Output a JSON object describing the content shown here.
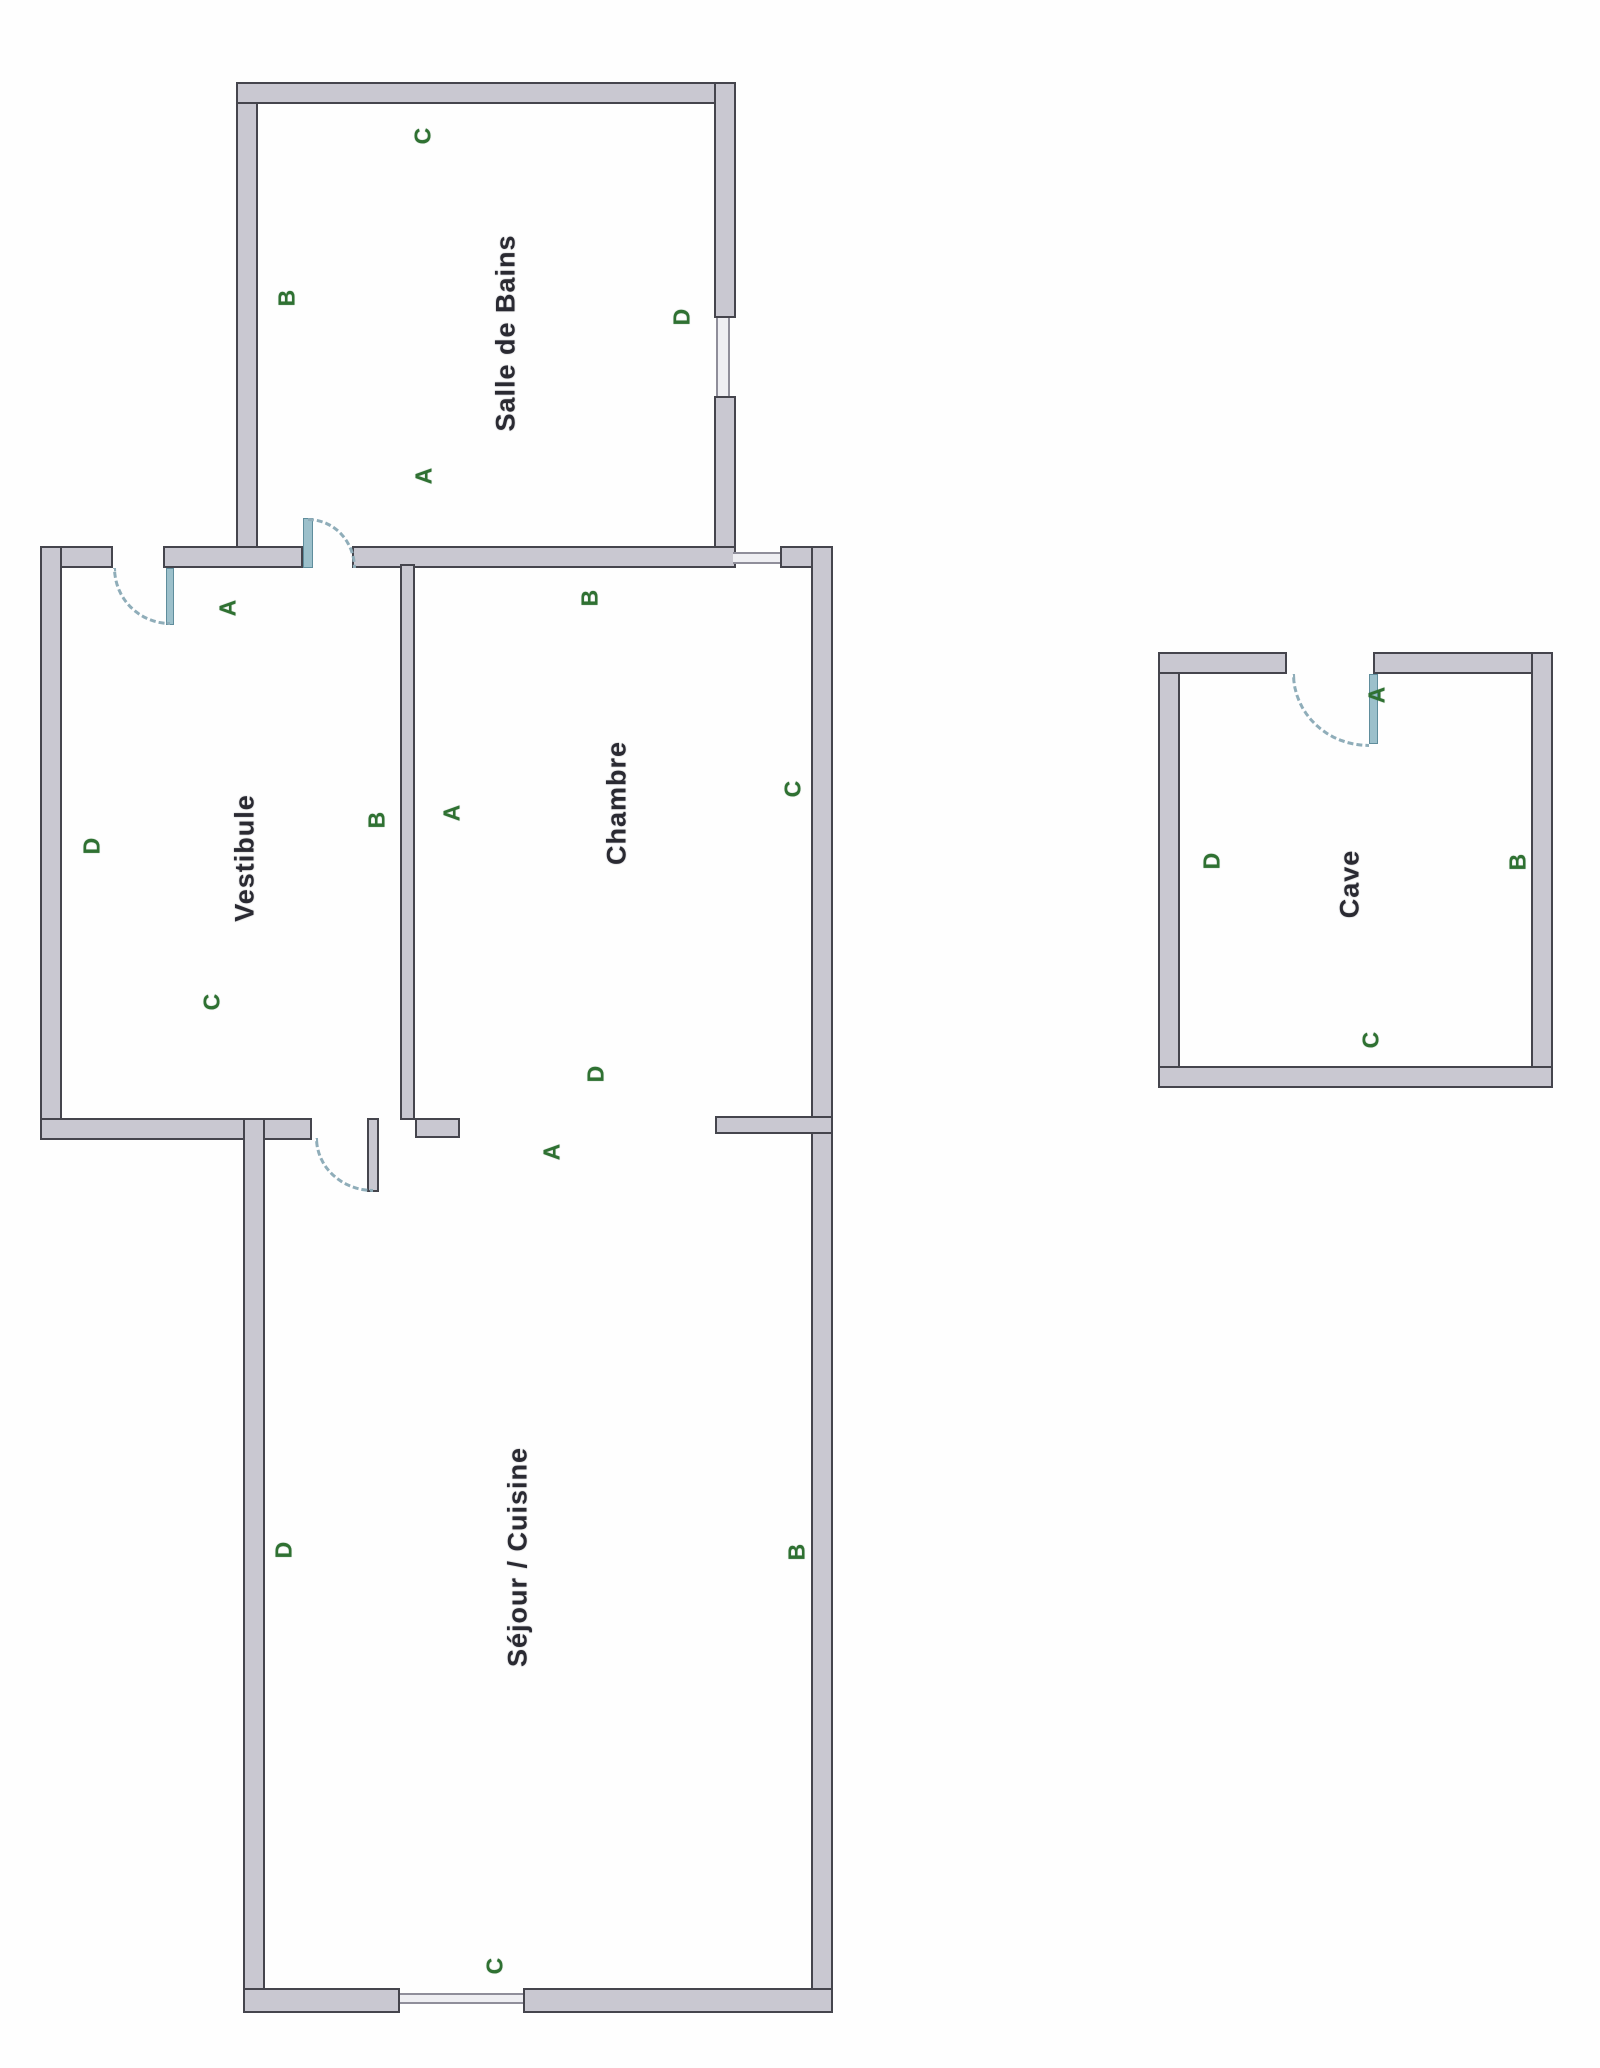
{
  "document": {
    "type": "scanned floor plan, rotated 90° counter-clockwise (all text reads bottom-to-top)"
  },
  "colors": {
    "background": "#fefefe",
    "wall_fill": "#c9c8d1",
    "wall_edge": "#45454d",
    "window_line": "#8f8e9a",
    "door_leaf_teal": "#9cc0cb",
    "door_arc_dash": "#8fadb9",
    "wall_label_green": "#2f7132",
    "room_name_dark": "#2a2a32"
  },
  "rooms": {
    "salle_de_bains": {
      "name": "Salle de Bains",
      "labels": {
        "a": "A",
        "b": "B",
        "c": "C",
        "d": "D"
      }
    },
    "vestibule": {
      "name": "Vestibule",
      "labels": {
        "a": "A",
        "b": "B",
        "c": "C",
        "d": "D"
      }
    },
    "chambre": {
      "name": "Chambre",
      "labels": {
        "a": "A",
        "b": "B",
        "c": "C",
        "d": "D"
      }
    },
    "sejour_cuisine": {
      "name": "Séjour / Cuisine",
      "labels": {
        "a": "A",
        "b": "B",
        "c": "C",
        "d": "D"
      }
    },
    "cave": {
      "name": "Cave",
      "labels": {
        "a": "A",
        "b": "B",
        "c": "C",
        "d": "D"
      }
    }
  },
  "features": {
    "doors": [
      "entry door swinging into vestibule (top wall)",
      "door vestibule to salle de bains (swings into bathroom)",
      "door vestibule to séjour/cuisine (swings into séjour)",
      "door into cave (top wall, swings into cave)"
    ],
    "windows": [
      "window on salle de bains right wall (D side)",
      "window on chambre top wall (B side)",
      "window on séjour/cuisine bottom wall (C side)"
    ],
    "openings": [
      "wide open passage between séjour/cuisine and chambre (A side)"
    ]
  }
}
